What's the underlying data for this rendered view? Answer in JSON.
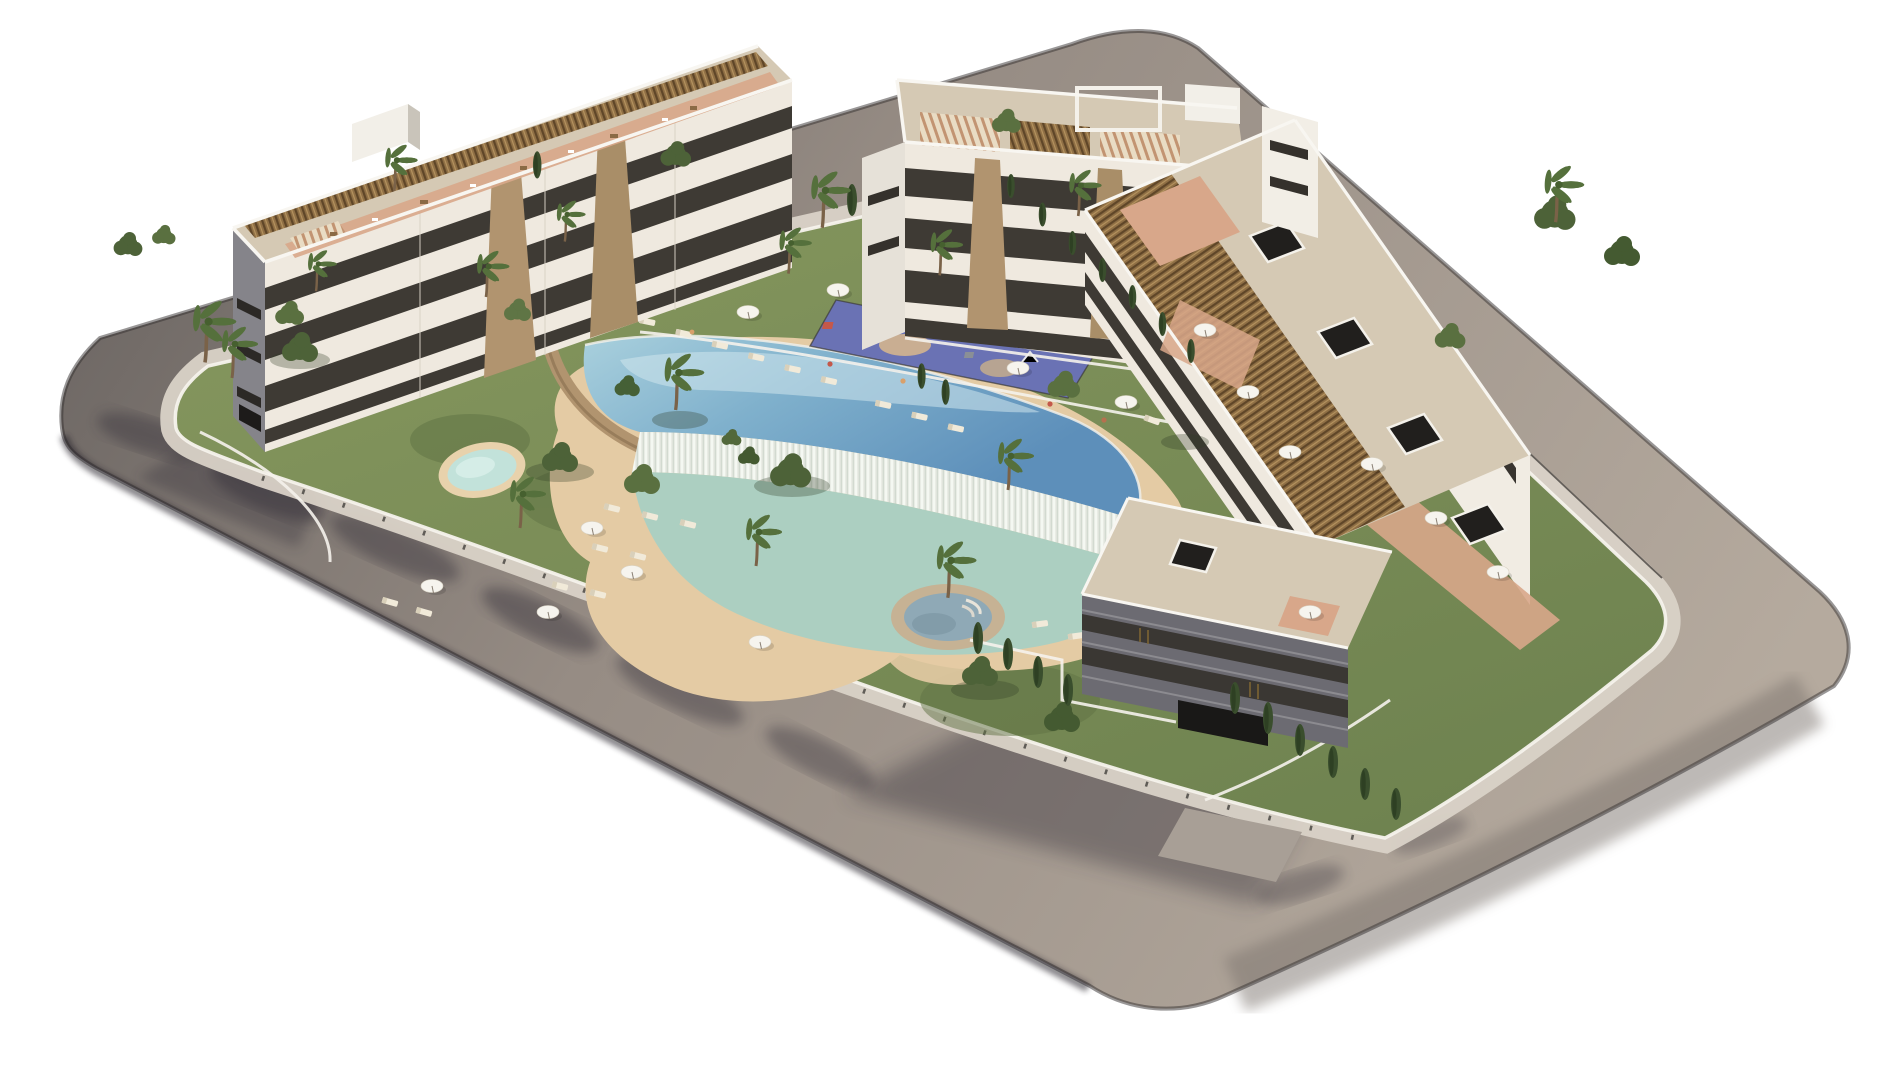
{
  "scene": {
    "type": "3d-architectural-rendering",
    "subject": "Aerial 3D render of a modern white apartment complex around a landscaped pool courtyard, enclosed by a curving perimeter road",
    "background": "#ffffff"
  },
  "palette": {
    "road_shadow": "#6b6562",
    "road_mid": "#968c84",
    "road_lit": "#b5aa9e",
    "road_edge": "#34302f",
    "sidewalk": "#d9d2c7",
    "ramp": "#a89f96",
    "lawn": "#87985f",
    "lawn_deep": "#6f8350",
    "sand": "#e4cba4",
    "pool_light": "#a9d0dd",
    "pool_deep": "#5d8fba",
    "cascade": "#e9ece5",
    "lagoon": "#a7cfc3",
    "kids_pool": "#c2e2da",
    "kids_rim": "#e8d2ac",
    "jacuzzi_water": "#8fa9b6",
    "jacuzzi_rim": "#c6b294",
    "stone_wall": "#b1946f",
    "deck": "#d5c9b4",
    "terracotta": "#d8a78a",
    "pergola": "#8f6f45",
    "facade": "#efe9df",
    "facade_shade": "#85848a",
    "facade_dark": "#6c6b72",
    "window": "#3e3a34",
    "window_deep": "#191817",
    "wall_white": "#f5f2ec",
    "tree": "#4d6238",
    "tree_light": "#6d8248",
    "palm": "#55703c",
    "cypress": "#3a4e2d",
    "playground_blue": "#6a72b4",
    "padel_blue": "#4d569e",
    "umbrella": "#f6f4ee",
    "lounger": "#f1ead9"
  },
  "complex": {
    "buildings": [
      {
        "id": "west-block",
        "floors": 4,
        "roof": "brown slatted pergolas, terracotta roof terraces, white roof-access box"
      },
      {
        "id": "north-block",
        "floors": 3,
        "roof": "striped pergola awnings, open white frame, roof-access box"
      },
      {
        "id": "east-block",
        "floors": 4,
        "roof": "continuous pergola strip, black skylight hatches, roof terraces"
      },
      {
        "id": "front-block",
        "floors": 3,
        "roof": "beige deck with skylight hatch, shaded street facade, garage entrance"
      }
    ],
    "amenities": [
      "infinity lagoon pool with beach entry",
      "white cascade water wall",
      "kids pool",
      "round jacuzzi with steps",
      "children playground",
      "padel court",
      "sun loungers",
      "white parasols",
      "palm and cypress gardens",
      "perimeter ring road",
      "garage ramp"
    ]
  }
}
